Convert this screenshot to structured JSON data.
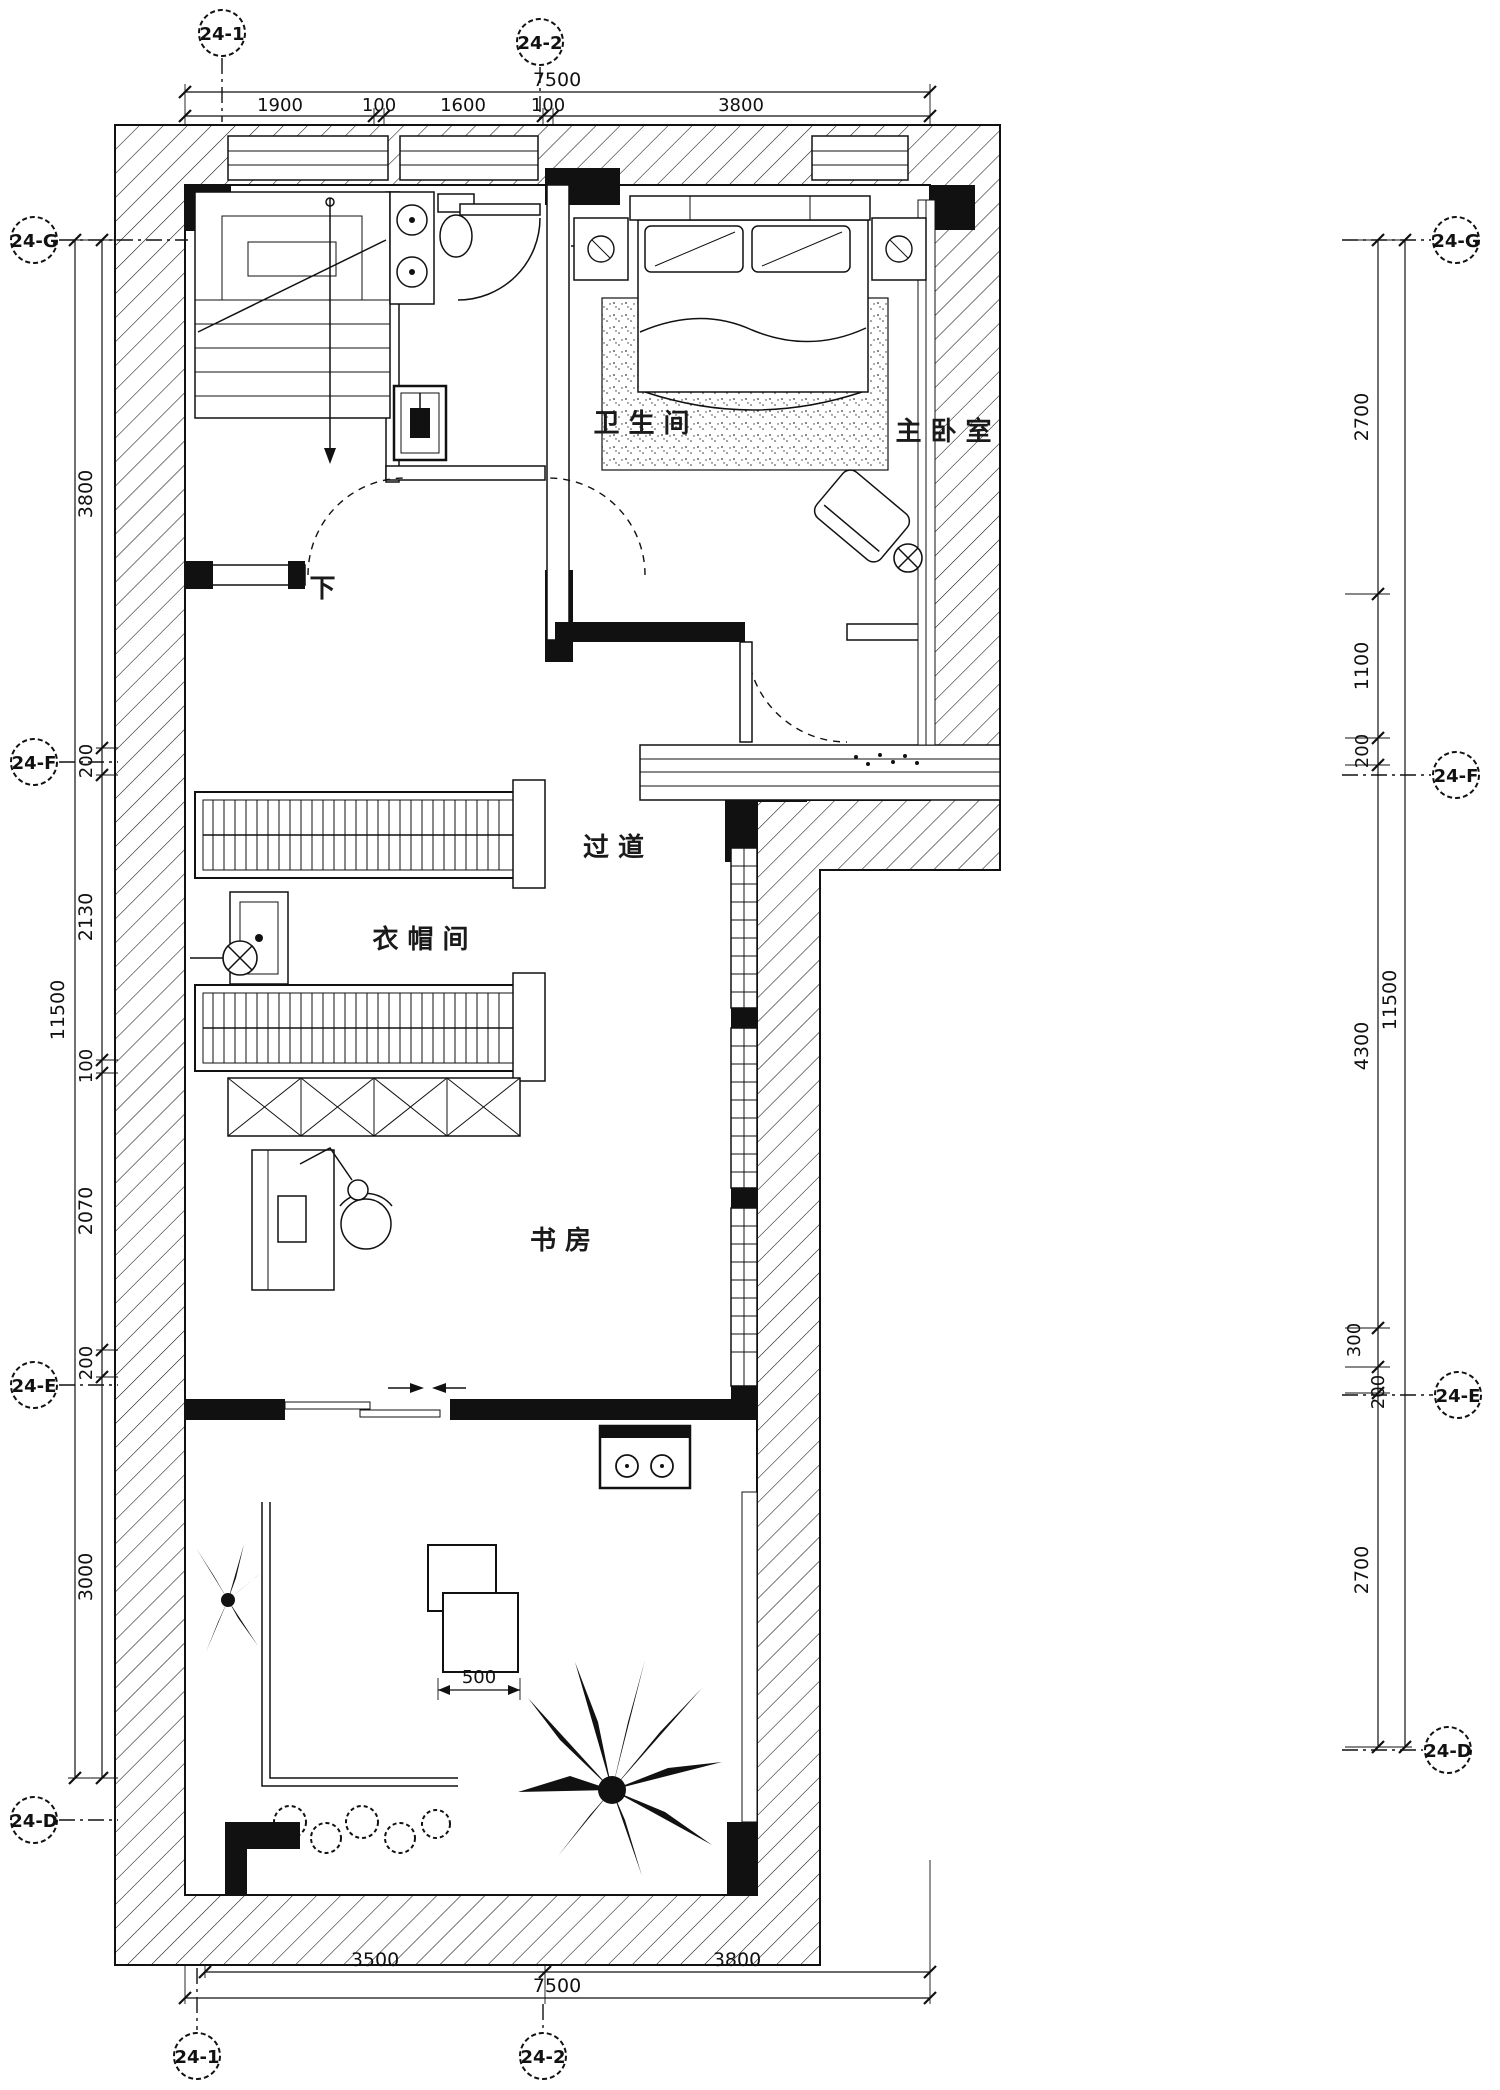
{
  "colors": {
    "ink": "#111111",
    "background": "#ffffff"
  },
  "axes": {
    "top": [
      "24-1",
      "24-2"
    ],
    "bottom": [
      "24-1",
      "24-2"
    ],
    "left": [
      "24-G",
      "24-F",
      "24-E",
      "24-D"
    ],
    "right": [
      "24-G",
      "24-F",
      "24-E",
      "24-D"
    ]
  },
  "dims": {
    "top_overall": "7500",
    "top_segments": [
      "1900",
      "100",
      "1600",
      "100",
      "3800"
    ],
    "bottom_overall": "7500",
    "bottom_segments": [
      "3500",
      "3800"
    ],
    "left_overall": "11500",
    "left_segments": [
      "3800",
      "200",
      "2130",
      "100",
      "2070",
      "200",
      "3000"
    ],
    "right_overall": "11500",
    "right_segments": [
      "2700",
      "1100",
      "200",
      "4300",
      "300",
      "200",
      "2700"
    ],
    "detail": "500"
  },
  "rooms": {
    "bathroom": "卫生间",
    "master_bedroom": "主卧室",
    "corridor": "过道",
    "cloakroom": "衣帽间",
    "study": "书房"
  },
  "annotations": {
    "stair_down": "下"
  }
}
